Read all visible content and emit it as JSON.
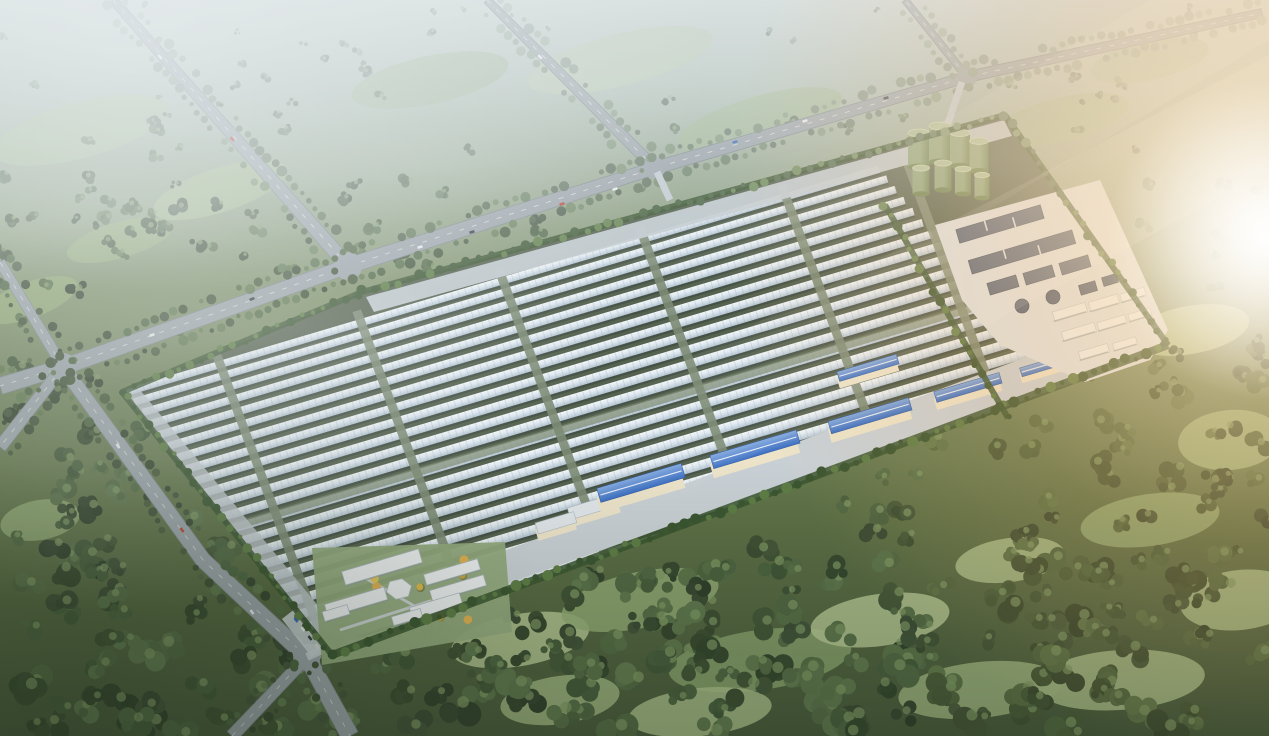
{
  "scene": {
    "description": "aerial-rendering-greenhouse-solar-farm-campus-in-misty-forest",
    "canvas": {
      "width": 1269,
      "height": 736
    },
    "seed": 1337,
    "palette": {
      "haze_sky": "#c6d0cd",
      "land_top": "#aebdb4",
      "land_mid": "#7e9069",
      "land_low": "#5d7046",
      "land_bottom": "#46573a",
      "fog": "#e9eff1",
      "sun_core": "#fff8ea",
      "sun_warm": "#ffd9a4",
      "sun_amber": "#f2b56d",
      "road": "#9aa3a9",
      "road_edge": "#7e878d",
      "road_line": "#e8ecee",
      "tree_palette": [
        "#3c4e33",
        "#46593a",
        "#516944",
        "#5d764c",
        "#42533a",
        "#364630",
        "#60794f",
        "#4b6340"
      ],
      "tree_highlight": "#7d9662",
      "tree_haze": "#b9c8c6",
      "tree_warm": "#6f7b44",
      "meadow_palette": [
        "#9db37f",
        "#a8bc88",
        "#90a873",
        "#b3c492",
        "#87a06c"
      ],
      "field_ground": "#55624f",
      "row_white": "#f4f8fa",
      "row_mid": "#dde7ee",
      "row_deep": "#b4c4d2",
      "row_shadow": "#39443e",
      "row_tick": "#8da0af",
      "aisle": "#7c8b74",
      "apron": "#c3cbd1",
      "pavement": "#c9d0d5",
      "hedge": "#3a5530",
      "hedge_bright": "#5d7c45",
      "tank_body": "#8aa57c",
      "tank_dark": "#64804e",
      "tank_top": "#abc09c",
      "tank_rim": "#c8dab6",
      "basin": "#4e5c74",
      "basin_dark": "#3a485c",
      "pad": "#dde2e6",
      "shed_wall": "#ece3c9",
      "shed_roof_blue": "#3c6fc2",
      "shed_roof_blue_light": "#85abe0",
      "shed_roof_pale": "#e0e5e9",
      "admin_roof": "#edf0f2",
      "admin_roof_edge": "#aeb8bf",
      "admin_ground": "#93aa7e",
      "gold_trees": [
        "#d9b94e",
        "#e2c55e",
        "#c9a63e",
        "#e0b052"
      ],
      "car_colors": [
        "#eceeef",
        "#2f343a",
        "#b8412f",
        "#3465b5",
        "#d8d8d2"
      ],
      "vignette": "#1c2a18",
      "cool_corner": "#24321f"
    },
    "field": {
      "polygon": [
        [
          362,
          292
        ],
        [
          1005,
          115
        ],
        [
          1168,
          345
        ],
        [
          332,
          655
        ],
        [
          122,
          392
        ]
      ],
      "rotation_deg": -16.5,
      "rotation_center": [
        640,
        400
      ],
      "rows": {
        "count": 23,
        "ry_start": 243,
        "ry_end": 548,
        "rx_start_top": 150,
        "rx_start_bottom": 268,
        "rx_end_top": 935,
        "rx_end_bottom": 1062,
        "h_top": 7.4,
        "h_bottom": 9.6
      },
      "aisles": {
        "rx": [
          258,
          405,
          553,
          700,
          848,
          974
        ],
        "lean": 0.068,
        "width": 9,
        "ry_top": 234,
        "ry_bottom": 556
      },
      "cross_aisle": {
        "ry": 402,
        "h": 8
      },
      "nw_apron": [
        [
          366,
          297
        ],
        [
          1004,
          120
        ],
        [
          1012,
          136
        ],
        [
          374,
          312
        ]
      ],
      "sw_apron": [
        [
          126,
          396
        ],
        [
          332,
          650
        ],
        [
          344,
          637
        ],
        [
          140,
          390
        ]
      ],
      "se_pavement": [
        [
          326,
          648
        ],
        [
          1160,
          352
        ],
        [
          1132,
          318
        ],
        [
          318,
          620
        ]
      ],
      "inner_hedge": [
        [
          885,
          205
        ],
        [
          1008,
          418
        ]
      ]
    },
    "roads": [
      {
        "name": "avenue-north-west",
        "pts": [
          [
            113,
            0
          ],
          [
            348,
            266
          ]
        ],
        "w": [
          9,
          15
        ]
      },
      {
        "name": "avenue-north-mid",
        "pts": [
          [
            487,
            0
          ],
          [
            655,
            168
          ]
        ],
        "w": [
          8,
          12
        ]
      },
      {
        "name": "frontage-boulevard",
        "pts": [
          [
            348,
            266
          ],
          [
            655,
            168
          ],
          [
            967,
            77
          ],
          [
            1262,
            13
          ]
        ],
        "w": [
          16,
          13,
          11,
          9
        ]
      },
      {
        "name": "west-road",
        "pts": [
          [
            348,
            266
          ],
          [
            63,
            367
          ],
          [
            0,
            386
          ]
        ],
        "w": [
          15,
          16,
          17
        ]
      },
      {
        "name": "west-upper-branch",
        "pts": [
          [
            63,
            367
          ],
          [
            0,
            262
          ]
        ],
        "w": [
          11,
          10
        ]
      },
      {
        "name": "west-lower-branch",
        "pts": [
          [
            63,
            367
          ],
          [
            0,
            447
          ]
        ],
        "w": [
          12,
          13
        ]
      },
      {
        "name": "perimeter-south-road",
        "pts": [
          [
            63,
            367
          ],
          [
            203,
            560
          ],
          [
            307,
            657
          ],
          [
            350,
            736
          ]
        ],
        "w": [
          14,
          16,
          17,
          18
        ]
      },
      {
        "name": "south-spur",
        "pts": [
          [
            307,
            657
          ],
          [
            232,
            736
          ]
        ],
        "w": [
          12,
          13
        ]
      },
      {
        "name": "north-exit",
        "pts": [
          [
            967,
            77
          ],
          [
            905,
            0
          ]
        ],
        "w": [
          8,
          7
        ]
      }
    ],
    "junctions": [
      [
        348,
        266,
        14
      ],
      [
        655,
        168,
        11
      ],
      [
        967,
        77,
        10
      ],
      [
        63,
        367,
        14
      ],
      [
        307,
        657,
        14
      ]
    ],
    "entrances": [
      {
        "from": [
          657,
          172
        ],
        "to": [
          670,
          200
        ],
        "w": 7
      },
      {
        "from": [
          962,
          82
        ],
        "to": [
          947,
          126
        ],
        "w": 7
      },
      {
        "from": [
          307,
          657
        ],
        "to": [
          368,
          628
        ],
        "w": 8
      }
    ],
    "utility": {
      "pad": [
        [
          935,
          225
        ],
        [
          1100,
          180
        ],
        [
          1168,
          330
        ],
        [
          1150,
          360
        ],
        [
          1085,
          382
        ],
        [
          1000,
          345
        ],
        [
          962,
          300
        ]
      ],
      "tanks_back": [
        {
          "x": 919,
          "y": 167,
          "r": 11,
          "h": 34
        },
        {
          "x": 940,
          "y": 162,
          "r": 11,
          "h": 36
        },
        {
          "x": 960,
          "y": 166,
          "r": 10,
          "h": 33
        },
        {
          "x": 979,
          "y": 171,
          "r": 9.5,
          "h": 30
        }
      ],
      "tanks_front": [
        {
          "x": 921,
          "y": 194,
          "r": 8.5,
          "h": 26
        },
        {
          "x": 943,
          "y": 190,
          "r": 8.5,
          "h": 27
        },
        {
          "x": 963,
          "y": 194,
          "r": 8,
          "h": 25
        },
        {
          "x": 982,
          "y": 198,
          "r": 7.5,
          "h": 23
        }
      ],
      "basin_bars": [
        {
          "x": 1000,
          "y": 224,
          "w": 88,
          "h": 14
        },
        {
          "x": 1022,
          "y": 252,
          "w": 108,
          "h": 14
        },
        {
          "x": 1003,
          "y": 285,
          "w": 30,
          "h": 12
        },
        {
          "x": 1039,
          "y": 275,
          "w": 30,
          "h": 12
        },
        {
          "x": 1075,
          "y": 265,
          "w": 30,
          "h": 12
        },
        {
          "x": 1088,
          "y": 288,
          "w": 17,
          "h": 10
        },
        {
          "x": 1110,
          "y": 280,
          "w": 15,
          "h": 9
        }
      ],
      "basin_circles": [
        {
          "x": 1022,
          "y": 306,
          "r": 7
        },
        {
          "x": 1053,
          "y": 297,
          "r": 7
        }
      ],
      "white_sheds": [
        {
          "x": 1070,
          "y": 312,
          "w": 34,
          "h": 10
        },
        {
          "x": 1104,
          "y": 303,
          "w": 30,
          "h": 10
        },
        {
          "x": 1133,
          "y": 295,
          "w": 25,
          "h": 9
        },
        {
          "x": 1079,
          "y": 332,
          "w": 34,
          "h": 10
        },
        {
          "x": 1112,
          "y": 323,
          "w": 29,
          "h": 9
        },
        {
          "x": 1140,
          "y": 315,
          "w": 23,
          "h": 8
        },
        {
          "x": 1094,
          "y": 352,
          "w": 30,
          "h": 9
        },
        {
          "x": 1125,
          "y": 344,
          "w": 24,
          "h": 8
        }
      ]
    },
    "warehouses": {
      "blue_sheds": [
        {
          "x": 641,
          "y": 489,
          "w": 88,
          "h": 16
        },
        {
          "x": 755,
          "y": 455,
          "w": 90,
          "h": 15
        },
        {
          "x": 870,
          "y": 421,
          "w": 84,
          "h": 14
        },
        {
          "x": 968,
          "y": 392,
          "w": 68,
          "h": 12
        },
        {
          "x": 1042,
          "y": 370,
          "w": 44,
          "h": 10
        },
        {
          "x": 868,
          "y": 372,
          "w": 62,
          "h": 11
        }
      ],
      "pale_sheds": [
        {
          "x": 594,
          "y": 511,
          "w": 52,
          "h": 13
        },
        {
          "x": 556,
          "y": 527,
          "w": 40,
          "h": 12
        }
      ]
    },
    "admin": {
      "ground": [
        [
          312,
          548
        ],
        [
          505,
          542
        ],
        [
          512,
          632
        ],
        [
          322,
          665
        ]
      ],
      "buildings": [
        {
          "type": "bar",
          "x": 382,
          "y": 567,
          "w": 80,
          "h": 14
        },
        {
          "type": "bar",
          "x": 452,
          "y": 572,
          "w": 56,
          "h": 11
        },
        {
          "type": "bar",
          "x": 458,
          "y": 588,
          "w": 56,
          "h": 11
        },
        {
          "type": "hex",
          "x": 399,
          "y": 589,
          "r": 13
        },
        {
          "type": "bar",
          "x": 356,
          "y": 602,
          "w": 62,
          "h": 13
        },
        {
          "type": "bar",
          "x": 336,
          "y": 613,
          "w": 26,
          "h": 10
        },
        {
          "type": "bar",
          "x": 436,
          "y": 606,
          "w": 52,
          "h": 12
        },
        {
          "type": "bar",
          "x": 407,
          "y": 617,
          "w": 30,
          "h": 9
        }
      ],
      "paths": [
        [
          [
            340,
            630
          ],
          [
            480,
            585
          ]
        ],
        [
          [
            360,
            575
          ],
          [
            432,
            616
          ]
        ]
      ],
      "gold_tree_area": [
        326,
        558,
        176,
        70
      ],
      "gold_tree_count": 16,
      "parking": {
        "x": 303,
        "y": 633,
        "angle": 52,
        "w": 48,
        "h": 16
      }
    },
    "cars": [
      [
        420,
        247,
        -17,
        0
      ],
      [
        472,
        232,
        -17,
        1
      ],
      [
        562,
        204,
        -16,
        2
      ],
      [
        615,
        189,
        -16,
        0
      ],
      [
        735,
        142,
        -16,
        3
      ],
      [
        805,
        121,
        -16,
        0
      ],
      [
        886,
        98,
        -16,
        1
      ],
      [
        160,
        57,
        48,
        0
      ],
      [
        232,
        139,
        48,
        2
      ],
      [
        540,
        57,
        45,
        0
      ],
      [
        152,
        335,
        -19,
        0
      ],
      [
        252,
        299,
        -19,
        1
      ],
      [
        118,
        446,
        54,
        0
      ],
      [
        182,
        530,
        54,
        2
      ],
      [
        252,
        612,
        52,
        0
      ],
      [
        296,
        620,
        52,
        3
      ],
      [
        303,
        629,
        52,
        0
      ],
      [
        310,
        638,
        52,
        1
      ],
      [
        317,
        646,
        52,
        4
      ]
    ],
    "meadows": [
      [
        80,
        130,
        90,
        28,
        -15
      ],
      [
        220,
        190,
        70,
        22,
        -18
      ],
      [
        430,
        80,
        80,
        24,
        -12
      ],
      [
        620,
        60,
        95,
        26,
        -14
      ],
      [
        760,
        120,
        85,
        24,
        -16
      ],
      [
        845,
        195,
        60,
        20,
        -16
      ],
      [
        1060,
        120,
        70,
        22,
        -14
      ],
      [
        1150,
        60,
        60,
        20,
        -12
      ],
      [
        30,
        300,
        50,
        18,
        -20
      ],
      [
        120,
        240,
        55,
        18,
        -16
      ],
      [
        1190,
        330,
        60,
        24,
        -10
      ],
      [
        1230,
        440,
        52,
        30,
        -5
      ],
      [
        1150,
        520,
        70,
        26,
        -8
      ],
      [
        1240,
        600,
        60,
        30,
        -6
      ],
      [
        1120,
        680,
        85,
        30,
        -4
      ],
      [
        520,
        640,
        70,
        26,
        -10
      ],
      [
        640,
        600,
        80,
        28,
        -12
      ],
      [
        760,
        660,
        92,
        30,
        -8
      ],
      [
        880,
        620,
        70,
        26,
        -8
      ],
      [
        980,
        690,
        82,
        28,
        -6
      ],
      [
        560,
        700,
        60,
        24,
        -8
      ],
      [
        700,
        712,
        72,
        24,
        -6
      ],
      [
        40,
        520,
        40,
        20,
        -10
      ],
      [
        1010,
        560,
        55,
        22,
        -8
      ]
    ],
    "forest": {
      "count": 380,
      "extra_bottom": 70,
      "extra_right": 55,
      "extra_left": 45,
      "extra_topleft": 35
    },
    "mist_patches": [
      [
        250,
        330,
        240,
        60,
        0.35
      ],
      [
        90,
        215,
        210,
        55,
        0.3
      ],
      [
        430,
        160,
        260,
        70,
        0.3
      ],
      [
        720,
        90,
        300,
        80,
        0.35
      ],
      [
        1000,
        160,
        260,
        70,
        0.28
      ]
    ],
    "flare": {
      "center": [
        1262,
        222
      ],
      "radius": 540,
      "core": [
        1266,
        240
      ],
      "core_radius": 160
    },
    "beams": [
      {
        "pts": "1269,55 1269,170 600,540 505,455",
        "g": "beamA"
      },
      {
        "pts": "1150,0 1269,0 1269,40 790,330 700,262",
        "g": "beamB"
      }
    ]
  }
}
